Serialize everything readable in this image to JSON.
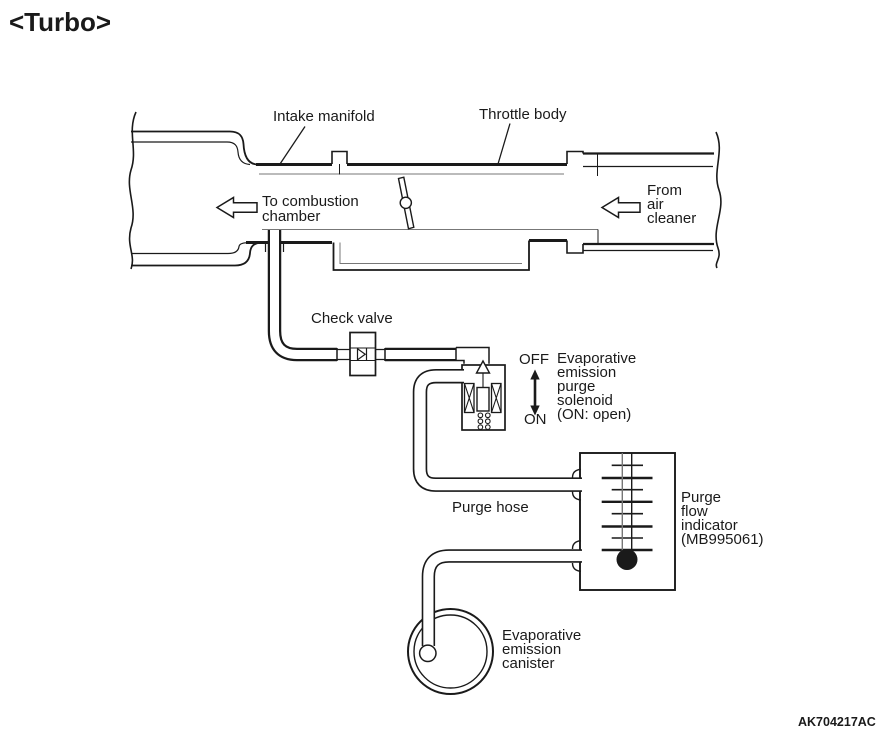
{
  "page": {
    "title": "<Turbo>",
    "figure_code": "AK704217AC",
    "colors": {
      "ink": "#1a1a1a",
      "ink_soft": "#777777",
      "paper": "#ffffff"
    }
  },
  "diagram": {
    "labels": {
      "intake_manifold": "Intake manifold",
      "throttle_body": "Throttle body",
      "to_combustion_chamber": "To combustion\nchamber",
      "from_air_cleaner": "From\nair\ncleaner",
      "check_valve": "Check valve",
      "solenoid_state_off": "OFF",
      "solenoid_state_on": "ON",
      "purge_solenoid": "Evaporative\nemission\npurge\nsolenoid\n(ON: open)",
      "purge_hose": "Purge hose",
      "purge_flow_indicator": "Purge\nflow\nindicator\n(MB995061)",
      "evap_canister": "Evaporative\nemission\ncanister"
    }
  }
}
